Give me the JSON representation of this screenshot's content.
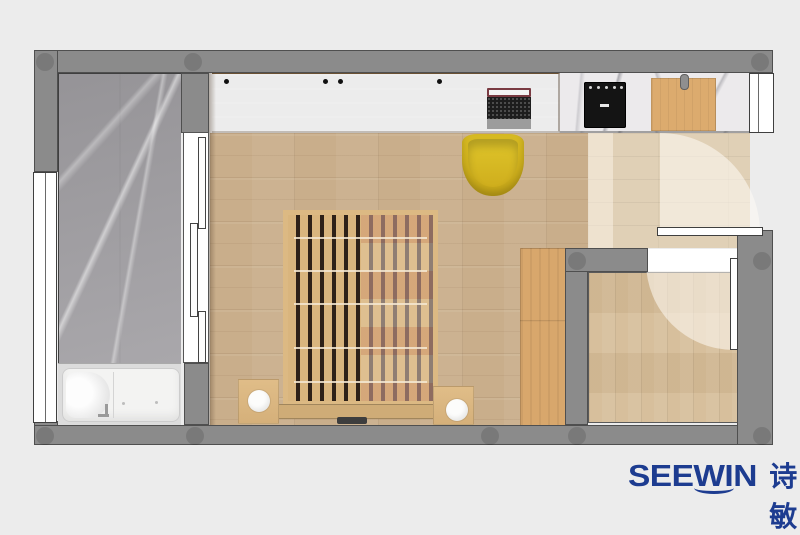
{
  "watermark": {
    "brand_latin": "SEEWIN",
    "brand_cjk": "诗敏"
  },
  "colors": {
    "background": "#ececec",
    "wall": "#8b8b8b",
    "wall_outline": "#4f4f4f",
    "marble_floor": "#a2a1a3",
    "counter_marble": "#eceaec",
    "wood_floor": "#c9ae8b",
    "hallway_wood": "#e0d0b6",
    "room_wood": "#d5bc97",
    "cabinet_wood": "#d8a76c",
    "slat_wood": "#dcb983",
    "chair_yellow": "#d3b51e",
    "tub_white": "#f3f3f2",
    "brand_blue": "#1d3c90"
  },
  "plan": {
    "type": "apartment floor plan, top view render",
    "rooms": [
      {
        "name": "bathroom",
        "features": [
          "gray-marble-floor",
          "walk-in-bathtub",
          "faucet",
          "triple-sliding-door",
          "left-window"
        ]
      },
      {
        "name": "main-room",
        "features": [
          "wood-plank-floor",
          "long-desk",
          "laptop",
          "yellow-tub-chair",
          "slatted-platform-bed",
          "two-side-tables",
          "two-round-lamps",
          "tall-cabinet"
        ]
      },
      {
        "name": "kitchenette",
        "features": [
          "white-marble-counter",
          "black-cooktop",
          "wood-cutting-board",
          "right-window"
        ]
      },
      {
        "name": "entry-hall",
        "features": [
          "light-wood-floor",
          "entry-door-open-90deg",
          "door-swing-arc"
        ]
      },
      {
        "name": "small-room",
        "features": [
          "vertical-plank-floor",
          "door-open-90deg",
          "door-swing-arc"
        ]
      }
    ],
    "structure": [
      "gray-walls-with-round-columns",
      "door-leaves-white",
      "windows-white"
    ]
  }
}
